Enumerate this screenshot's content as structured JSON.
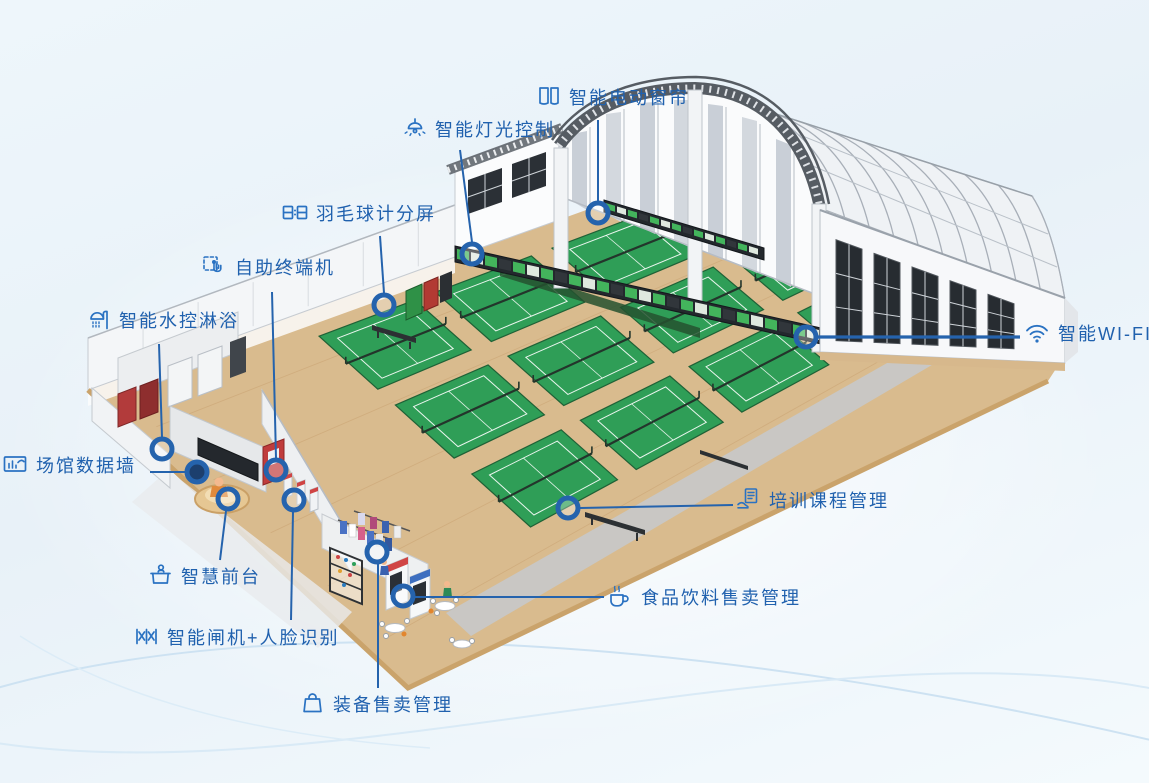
{
  "features": [
    {
      "id": "curtain",
      "label": "智能电动窗帘",
      "icon": "curtain-icon"
    },
    {
      "id": "lighting",
      "label": "智能灯光控制",
      "icon": "lamp-icon"
    },
    {
      "id": "scoreboard",
      "label": "羽毛球计分屏",
      "icon": "scoreboard-icon"
    },
    {
      "id": "kiosk",
      "label": "自助终端机",
      "icon": "touch-icon"
    },
    {
      "id": "shower",
      "label": "智能水控淋浴",
      "icon": "shower-icon"
    },
    {
      "id": "datawall",
      "label": "场馆数据墙",
      "icon": "datawall-icon"
    },
    {
      "id": "frontdesk",
      "label": "智慧前台",
      "icon": "desk-icon"
    },
    {
      "id": "gate",
      "label": "智能闸机+人脸识别",
      "icon": "gate-icon"
    },
    {
      "id": "equipment",
      "label": "装备售卖管理",
      "icon": "bag-icon"
    },
    {
      "id": "food",
      "label": "食品饮料售卖管理",
      "icon": "cup-icon"
    },
    {
      "id": "training",
      "label": "培训课程管理",
      "icon": "course-icon"
    },
    {
      "id": "wifi",
      "label": "智能WI-FI",
      "icon": "wifi-icon"
    }
  ],
  "colors": {
    "label_text": "#2061ae",
    "callout_line": "#2563ad",
    "marker_ring": "#2563ad",
    "court_green": "#2f9e57",
    "floor_wood": "#d9bb8e",
    "roof_truss": "#565c63",
    "led_green": "#43b45c"
  }
}
